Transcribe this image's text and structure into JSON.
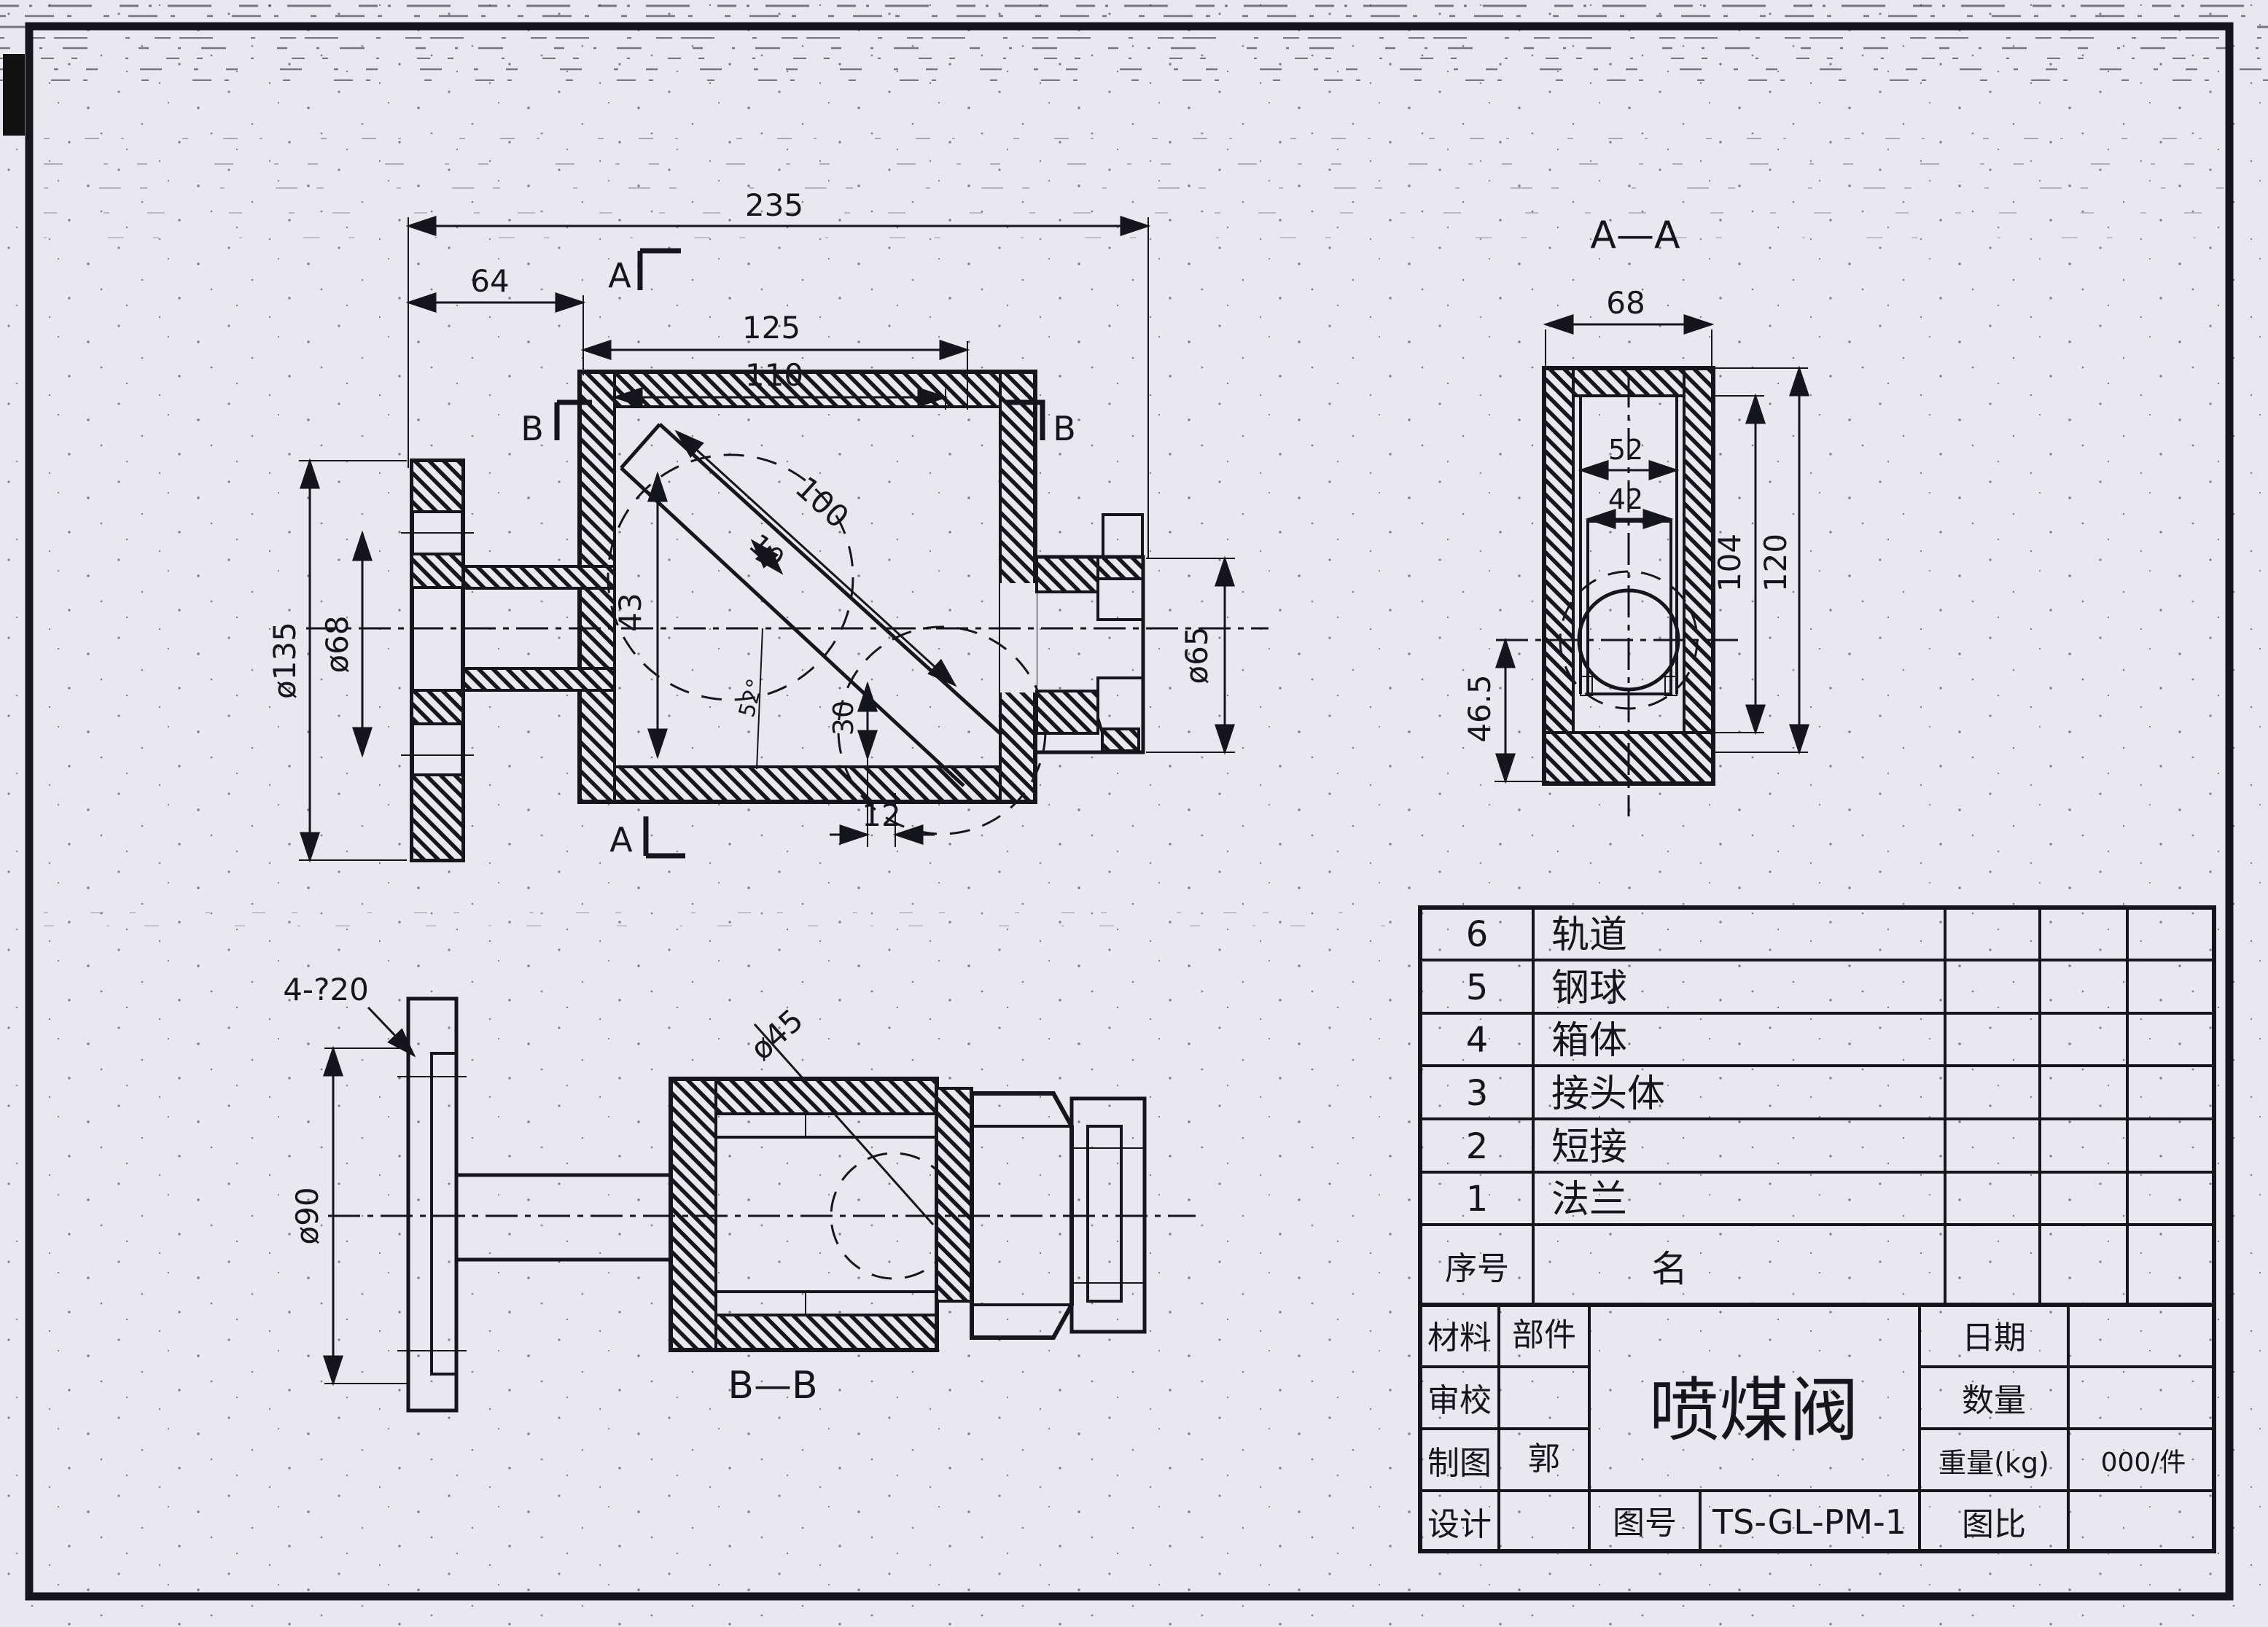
{
  "front": {
    "dim_235": "235",
    "dim_64": "64",
    "dim_125": "125",
    "dim_110": "110",
    "dim_100": "100",
    "dim_10": "10",
    "dim_43": "43",
    "dim_30": "30",
    "dim_12": "12",
    "dim_d135": "ø135",
    "dim_d68": "ø68",
    "dim_d65": "ø65",
    "angle": "52°",
    "marker_a_top": "A",
    "marker_a_bottom": "A",
    "marker_b_left": "B",
    "marker_b_right": "B"
  },
  "aa": {
    "label": "A—A",
    "dim_68": "68",
    "dim_52": "52",
    "dim_42": "42",
    "dim_104": "104",
    "dim_120": "120",
    "dim_46_5": "46.5"
  },
  "bb": {
    "label": "B—B",
    "dim_4_20": "4-?20",
    "dim_d90": "ø90",
    "dim_d45": "ø45"
  },
  "parts_table": {
    "header_no": "序号",
    "header_name": "名",
    "rows": [
      {
        "no": "6",
        "name": "轨道"
      },
      {
        "no": "5",
        "name": "钢球"
      },
      {
        "no": "4",
        "name": "箱体"
      },
      {
        "no": "3",
        "name": "接头体"
      },
      {
        "no": "2",
        "name": "短接"
      },
      {
        "no": "1",
        "name": "法兰"
      }
    ]
  },
  "title_block": {
    "material_label": "材料",
    "part_label": "部件",
    "check_label": "审校",
    "draft_label": "制图",
    "draft_by": "郭",
    "design_label": "设计",
    "drawing_no_label": "图号",
    "drawing_no": "TS-GL-PM-1",
    "title": "喷煤阀",
    "date_label": "日期",
    "qty_label": "数量",
    "weight_label": "重量(kg)",
    "weight_value": "000/件",
    "scale_label": "图比"
  }
}
